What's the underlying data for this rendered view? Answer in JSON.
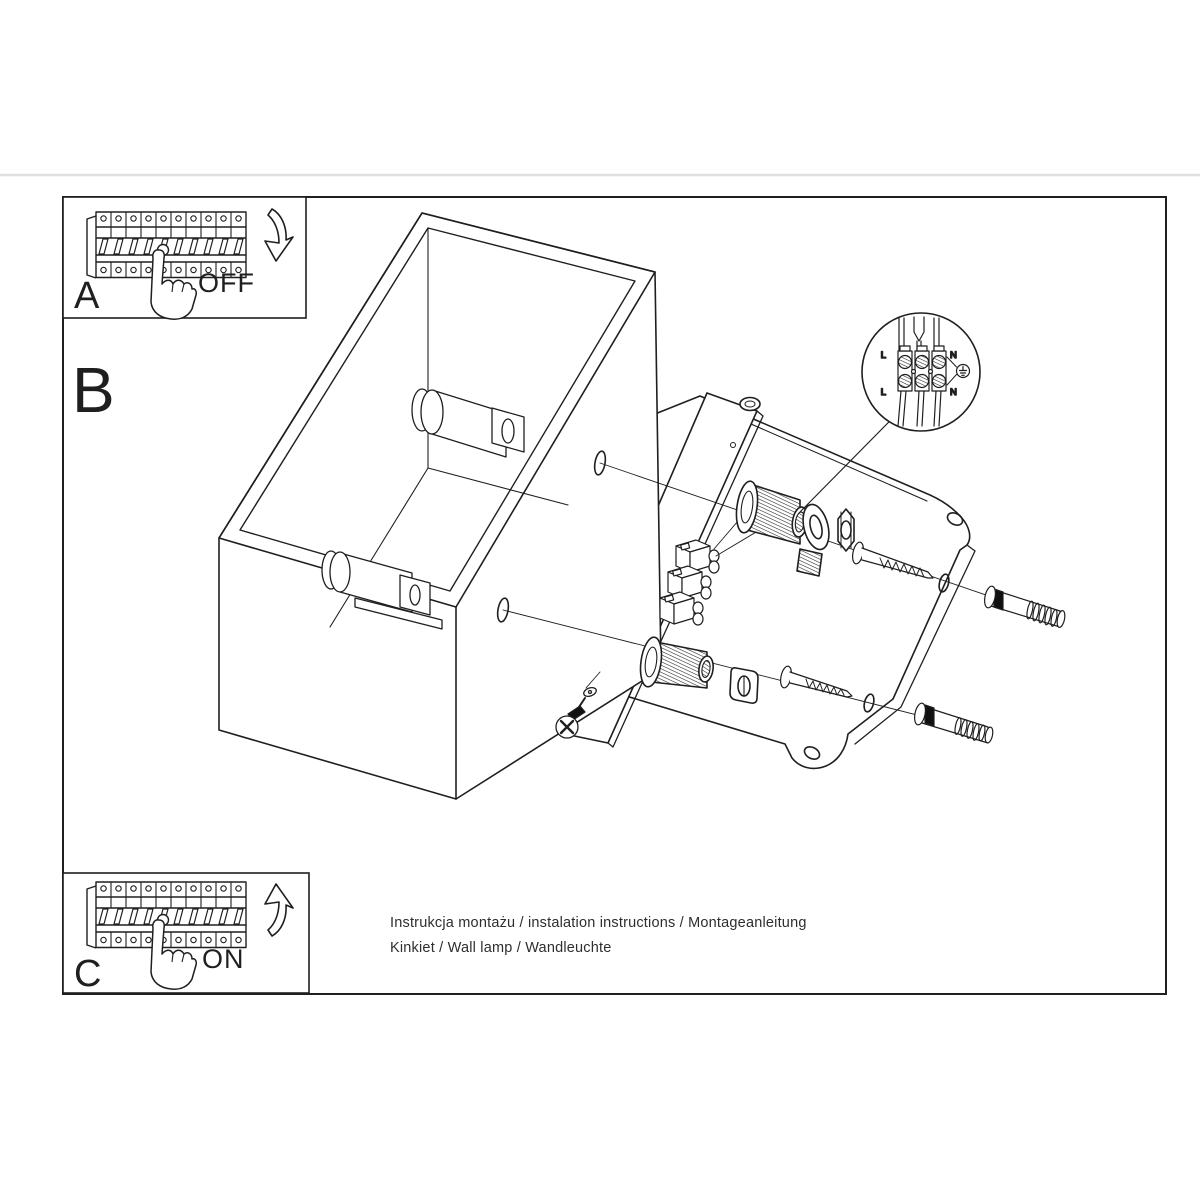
{
  "page": {
    "background": "#ffffff"
  },
  "colors": {
    "line": "#1f1f1f",
    "separator": "#e0e0e0",
    "text": "#2e2e2e"
  },
  "steps": {
    "a": {
      "label": "A",
      "state": "OFF"
    },
    "b": {
      "label": "B"
    },
    "c": {
      "label": "C",
      "state": "ON"
    }
  },
  "wiring_detail": {
    "top_left": "L",
    "top_right": "N",
    "bottom_left": "L",
    "bottom_right": "N"
  },
  "footer": {
    "line1": "Instrukcja montażu / instalation instructions / Montageanleitung",
    "line2": "Kinkiet / Wall lamp / Wandleuchte"
  }
}
